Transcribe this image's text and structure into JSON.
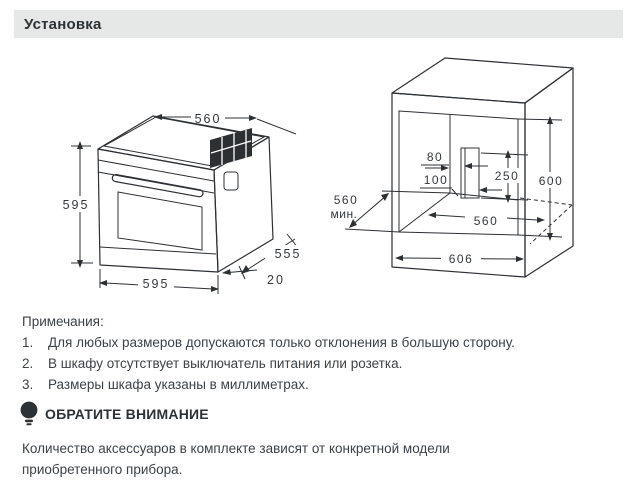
{
  "header": {
    "title": "Установка"
  },
  "oven_diagram": {
    "dims": {
      "top_width": "560",
      "height": "595",
      "bottom_width": "595",
      "depth": "555",
      "door_offset": "20"
    }
  },
  "cabinet_diagram": {
    "dims": {
      "vent_offset": "80",
      "hole_offset": "100",
      "hole_height": "250",
      "niche_height": "600",
      "depth_min_value": "560",
      "depth_min_suffix": "мин.",
      "niche_width": "560",
      "outer_width": "606"
    }
  },
  "notes": {
    "heading": "Примечания:",
    "items": [
      {
        "num": "1.",
        "text": "Для любых размеров допускаются только отклонения в большую сторону."
      },
      {
        "num": "2.",
        "text": "В шкафу отсутствует выключатель питания или розетка."
      },
      {
        "num": "3.",
        "text": "Размеры шкафа указаны в миллиметрах."
      }
    ]
  },
  "attention": {
    "label": "ОБРАТИТЕ ВНИМАНИЕ",
    "text": "Количество аксессуаров в комплекте зависят от конкретной модели приобретенного прибора."
  },
  "colors": {
    "line": "#2d3034",
    "text": "#3d4248",
    "header_bg": "#e6e8e7",
    "icon": "#2c3136"
  }
}
